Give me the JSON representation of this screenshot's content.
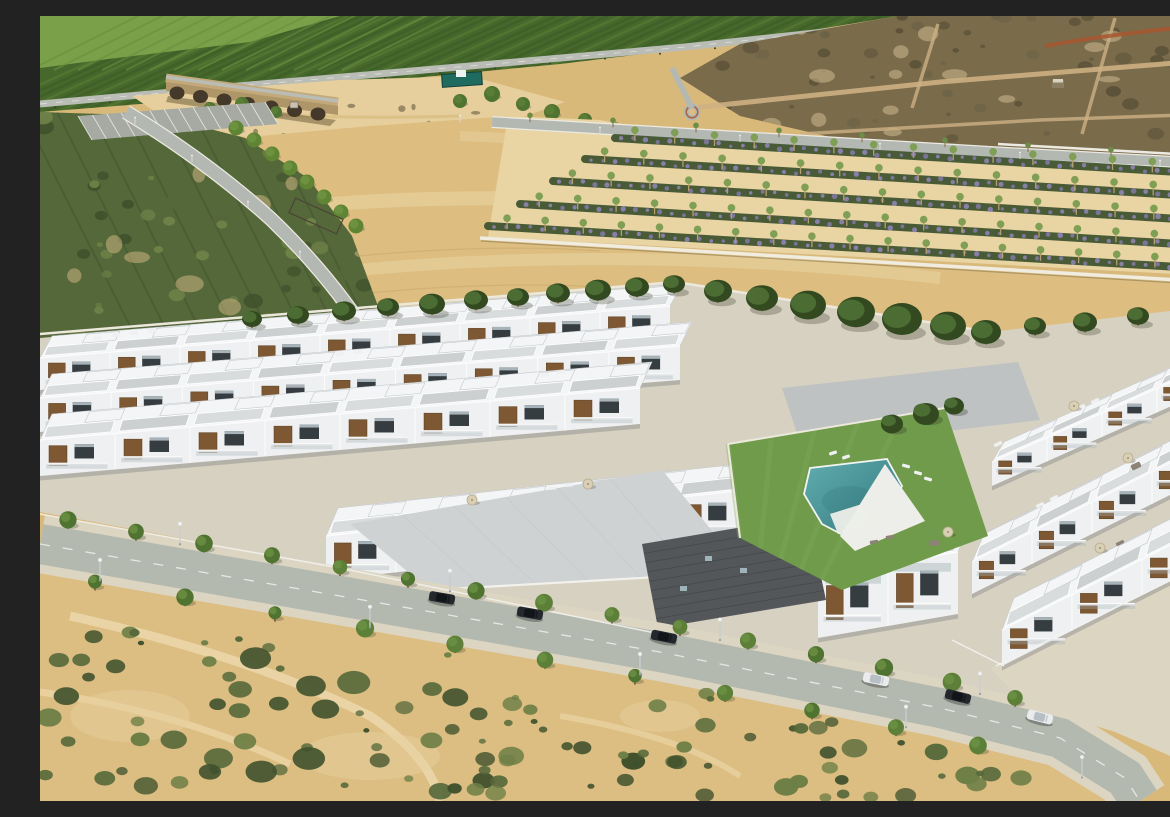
{
  "scene": {
    "title": "Aerial view of a modern white residential development beside dry farmland",
    "subject": "New-build complex of white flat-roofed townhouses with wood-slat accents, roof terraces with parasols and sun loungers, a communal lawn with a turquoise swimming pool, fronted by a tree-lined street with parked cars; sandy scrubland in the foreground; tan fields, lavender planting rows, an olive grove, a stone arched bridge, a highway and green orchards on the hillside behind"
  },
  "palette": {
    "base": "#d9b97a",
    "orchard": "#47682c",
    "orchardDark": "#395922",
    "orchardLight": "#5d8036",
    "cornerField": "#7fa64d",
    "cornerRow": "#69903f",
    "hillRoad": "#b9bdb6",
    "scrub": "#7a6b4b",
    "scrubDark": "#5a5138",
    "scrubMid": "#6b6246",
    "scrubPatch": "#c7ab79",
    "riverbed": "#e6cf9c",
    "bridgeStone": "#c3a97a",
    "bridgeWall": "#ae9668",
    "arch": "#44392b",
    "enclosure": "#206b5f",
    "field": "#ddbe80",
    "fieldLight": "#ecd7a8",
    "fieldDark": "#c9a96c",
    "lavZone": "#e9d4a4",
    "lavGreen": "#3f5430",
    "lavPurple": "#8b7cba",
    "lavPurple2": "#9d8bcf",
    "lavTree": "#7fa054",
    "trunk": "#8a6b42",
    "road": "#b4b8b2",
    "roadEdge": "#eceae2",
    "redPath": "#a8562f",
    "scrubL1": "#3f512c",
    "scrubL2": "#55683a",
    "scrubL3": "#6e8248",
    "sandGap": "#d6ba85",
    "pine": "#4b6c33",
    "pineDark": "#33491f",
    "pineTrunk": "#7a5a36",
    "devGround": "#d7d1c1",
    "wallWhite": "#ece8dc",
    "white": "#f4f5f6",
    "facade": "#eef0f1",
    "shade": "#dfe2e4",
    "edge": "#c5cacd",
    "pavers": "#ccd0d1",
    "paversLight": "#d9dcdd",
    "deckGray": "#bfc2c3",
    "wood": "#7d5832",
    "woodDark": "#5a3d1f",
    "win": "#363d40",
    "glass": "#a7b3b8",
    "darkRoof": "#54575a",
    "darkRoofLine": "#404448",
    "lawn": "#6f9b4b",
    "lawnLight": "#82ab5a",
    "pool1": "#61adb0",
    "pool2": "#2f7479",
    "poolDeck": "#edeee9",
    "street": "#b4b9af",
    "sidewalk": "#dcd5c2",
    "mark": "#f2f2ef",
    "sandFg": "#dcbd82",
    "pathSand": "#ecd8ab",
    "carDark": "#24272c",
    "carWhite": "#e9ebec",
    "carGlassD": "#11151a",
    "carGlassW": "#b7bfc5",
    "umbrella": "#d9cfb4",
    "loungeW": "#eef0f1",
    "loungeG": "#8c8275",
    "treeGreen": "#5d8038",
    "treeGreen2": "#4f7330",
    "treeTrunk": "#6b4e2e",
    "lamp": "#c9cdcf"
  },
  "landscape": {
    "highway": [
      [
        0,
        88
      ],
      [
        210,
        69
      ],
      [
        430,
        50
      ],
      [
        645,
        31
      ],
      [
        858,
        8
      ]
    ],
    "bridge": {
      "arches": 7,
      "x": 137,
      "y": 74,
      "stepX": 23.5,
      "stepY": 3.5
    },
    "roadB": [
      [
        452,
        106
      ],
      [
        700,
        121
      ],
      [
        950,
        136
      ],
      [
        1172,
        148
      ]
    ],
    "plantationRows": [
      [
        575,
        122,
        1172,
        158
      ],
      [
        545,
        143,
        1172,
        181
      ],
      [
        513,
        165,
        1172,
        205
      ],
      [
        480,
        188,
        1172,
        230
      ],
      [
        448,
        210,
        1172,
        253
      ]
    ],
    "parkTrees": [
      [
        196,
        112
      ],
      [
        214,
        124
      ],
      [
        232,
        138
      ],
      [
        250,
        152
      ],
      [
        267,
        166
      ],
      [
        284,
        181
      ],
      [
        301,
        196
      ],
      [
        316,
        210
      ]
    ],
    "riverTrees": [
      [
        420,
        85,
        7
      ],
      [
        452,
        78,
        8
      ],
      [
        483,
        88,
        7
      ],
      [
        512,
        96,
        8
      ],
      [
        545,
        104,
        7
      ],
      [
        575,
        112,
        6
      ],
      [
        170,
        92,
        6
      ],
      [
        202,
        88,
        7
      ],
      [
        236,
        96,
        6
      ]
    ],
    "pines": [
      [
        212,
        305,
        10
      ],
      [
        258,
        301,
        11
      ],
      [
        304,
        297,
        12
      ],
      [
        348,
        293,
        11
      ],
      [
        392,
        290,
        13
      ],
      [
        436,
        286,
        12
      ],
      [
        478,
        283,
        11
      ],
      [
        518,
        279,
        12
      ],
      [
        558,
        276,
        13
      ],
      [
        597,
        273,
        12
      ],
      [
        634,
        270,
        11
      ],
      [
        678,
        277,
        14
      ],
      [
        722,
        284,
        16
      ],
      [
        768,
        291,
        18
      ],
      [
        816,
        298,
        19
      ],
      [
        862,
        305,
        20
      ],
      [
        908,
        312,
        18
      ],
      [
        946,
        318,
        15
      ],
      [
        995,
        312,
        11
      ],
      [
        1045,
        308,
        12
      ],
      [
        1098,
        302,
        11
      ],
      [
        1148,
        297,
        10
      ]
    ],
    "courtyardTrees": [
      [
        852,
        408,
        11
      ],
      [
        886,
        398,
        13
      ],
      [
        914,
        390,
        10
      ]
    ]
  },
  "development": {
    "buildingRows": [
      {
        "name": "row-back-west",
        "x1": 0,
        "y1": 342,
        "x2": 630,
        "y2": 290,
        "fh": 32,
        "rd": 22,
        "units": 9
      },
      {
        "name": "row-mid-west",
        "x1": 0,
        "y1": 382,
        "x2": 640,
        "y2": 330,
        "fh": 34,
        "rd": 24,
        "units": 9
      },
      {
        "name": "row-front-west",
        "x1": 0,
        "y1": 424,
        "x2": 600,
        "y2": 372,
        "fh": 36,
        "rd": 26,
        "units": 8
      },
      {
        "name": "row-center",
        "x1": 286,
        "y1": 520,
        "x2": 706,
        "y2": 474,
        "fh": 44,
        "rd": 28,
        "units": 6
      },
      {
        "name": "row-center-front-blocks",
        "x1": 778,
        "y1": 560,
        "x2": 918,
        "y2": 536,
        "fh": 62,
        "rd": 30,
        "units": 2
      },
      {
        "name": "row-right-back",
        "x1": 952,
        "y1": 446,
        "x2": 1172,
        "y2": 348,
        "fh": 24,
        "rd": 20,
        "units": 4
      },
      {
        "name": "row-right-mid",
        "x1": 932,
        "y1": 546,
        "x2": 1172,
        "y2": 426,
        "fh": 32,
        "rd": 28,
        "units": 4
      },
      {
        "name": "row-right-front",
        "x1": 962,
        "y1": 614,
        "x2": 1172,
        "y2": 508,
        "fh": 36,
        "rd": 32,
        "units": 3
      }
    ],
    "pool": [
      [
        770,
        452
      ],
      [
        847,
        443
      ],
      [
        862,
        470
      ],
      [
        846,
        500
      ],
      [
        820,
        528
      ],
      [
        782,
        508
      ],
      [
        764,
        478
      ]
    ],
    "lawn": [
      [
        688,
        428
      ],
      [
        905,
        392
      ],
      [
        948,
        520
      ],
      [
        802,
        574
      ],
      [
        700,
        522
      ]
    ],
    "umbrellas": [
      [
        908,
        516
      ],
      [
        1088,
        442
      ],
      [
        1034,
        390
      ],
      [
        548,
        468
      ],
      [
        432,
        484
      ],
      [
        1060,
        532
      ]
    ],
    "roofLoungers": [
      [
        58,
        322,
        -5,
        "w"
      ],
      [
        76,
        319,
        -5,
        "w"
      ],
      [
        94,
        317,
        -5,
        "w"
      ],
      [
        112,
        315,
        -5,
        "w"
      ],
      [
        300,
        338,
        -5,
        "w"
      ],
      [
        318,
        336,
        -5,
        "w"
      ],
      [
        505,
        359,
        -5,
        "w"
      ],
      [
        521,
        356,
        -5,
        "w"
      ],
      [
        512,
        472,
        -5,
        "w"
      ],
      [
        529,
        469,
        -5,
        "w"
      ],
      [
        834,
        526,
        -10,
        "g"
      ],
      [
        850,
        521,
        -10,
        "g"
      ],
      [
        1000,
        489,
        -26,
        "w"
      ],
      [
        1014,
        482,
        -26,
        "w"
      ],
      [
        1041,
        391,
        -26,
        "w"
      ],
      [
        1055,
        385,
        -26,
        "w"
      ],
      [
        958,
        428,
        -26,
        "w"
      ],
      [
        1080,
        527,
        -26,
        "g"
      ]
    ],
    "poolLoungers": [
      [
        793,
        437,
        -18
      ],
      [
        806,
        441,
        -18
      ],
      [
        866,
        450,
        15
      ],
      [
        878,
        457,
        15
      ],
      [
        888,
        463,
        15
      ]
    ],
    "wickerSets": [
      [
        894,
        527,
        -8
      ],
      [
        1096,
        450,
        -26
      ]
    ]
  },
  "street": {
    "path": [
      [
        0,
        528
      ],
      [
        300,
        580
      ],
      [
        620,
        636
      ],
      [
        900,
        692
      ],
      [
        1020,
        722
      ],
      [
        1085,
        762
      ],
      [
        1100,
        785
      ]
    ],
    "cars": [
      {
        "x": 402,
        "body": "dark"
      },
      {
        "x": 490,
        "body": "dark"
      },
      {
        "x": 624,
        "body": "dark"
      },
      {
        "x": 836,
        "body": "white"
      },
      {
        "x": 918,
        "body": "dark"
      },
      {
        "x": 1000,
        "body": "white"
      }
    ],
    "treesTop": [
      28,
      96,
      164,
      232,
      300,
      368,
      436,
      504,
      572,
      640,
      708,
      776,
      844,
      912,
      975
    ],
    "treesBottom": [
      55,
      145,
      235,
      325,
      415,
      505,
      595,
      685,
      772,
      856,
      938
    ],
    "lamps": [
      [
        140,
        -1
      ],
      [
        410,
        -1
      ],
      [
        680,
        -1
      ],
      [
        940,
        -1
      ],
      [
        60,
        1
      ],
      [
        330,
        1
      ],
      [
        600,
        1
      ],
      [
        866,
        1
      ],
      [
        1042,
        1
      ]
    ]
  },
  "foreground": {
    "bushCount": 95,
    "clusterCount": 22,
    "seed": 11
  }
}
